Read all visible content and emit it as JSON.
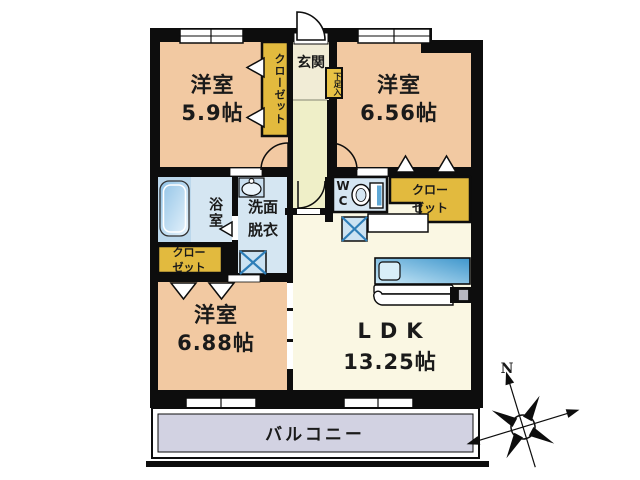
{
  "plan": {
    "bedroom1": {
      "name": "洋室",
      "size": "5.9帖"
    },
    "bedroom2": {
      "name": "洋室",
      "size": "6.56帖"
    },
    "bedroom3": {
      "name": "洋室",
      "size": "6.88帖"
    },
    "ldk": {
      "name": "LDK",
      "size": "13.25帖"
    },
    "entrance": {
      "label": "玄関"
    },
    "shoe_cabinet": {
      "label": "下足入"
    },
    "hall_closet": {
      "label": "クローゼット"
    },
    "bathroom": {
      "label": "浴室"
    },
    "washroom": {
      "line1": "洗面",
      "line2": "脱衣"
    },
    "toilet": {
      "line1": "W",
      "line2": "C"
    },
    "closet_right": {
      "line1": "クロー",
      "line2": "ゼット"
    },
    "closet_left": {
      "line1": "クロー",
      "line2": "ゼット"
    },
    "balcony": {
      "label": "バルコニー"
    }
  },
  "compass": {
    "north": "N"
  },
  "colors": {
    "wall": "#0d0d0d",
    "room_peach": "#F2C9A2",
    "hall_yellow": "#EFEFC8",
    "entrance_cream": "#F1ECD6",
    "ldk_cream": "#FAF7E3",
    "closet_yellow": "#E2BA3E",
    "wet_area_blue": "#D5E6F2",
    "fixture_blue": "#5FA8D6",
    "balcony_lavender": "#D2D2E2"
  }
}
